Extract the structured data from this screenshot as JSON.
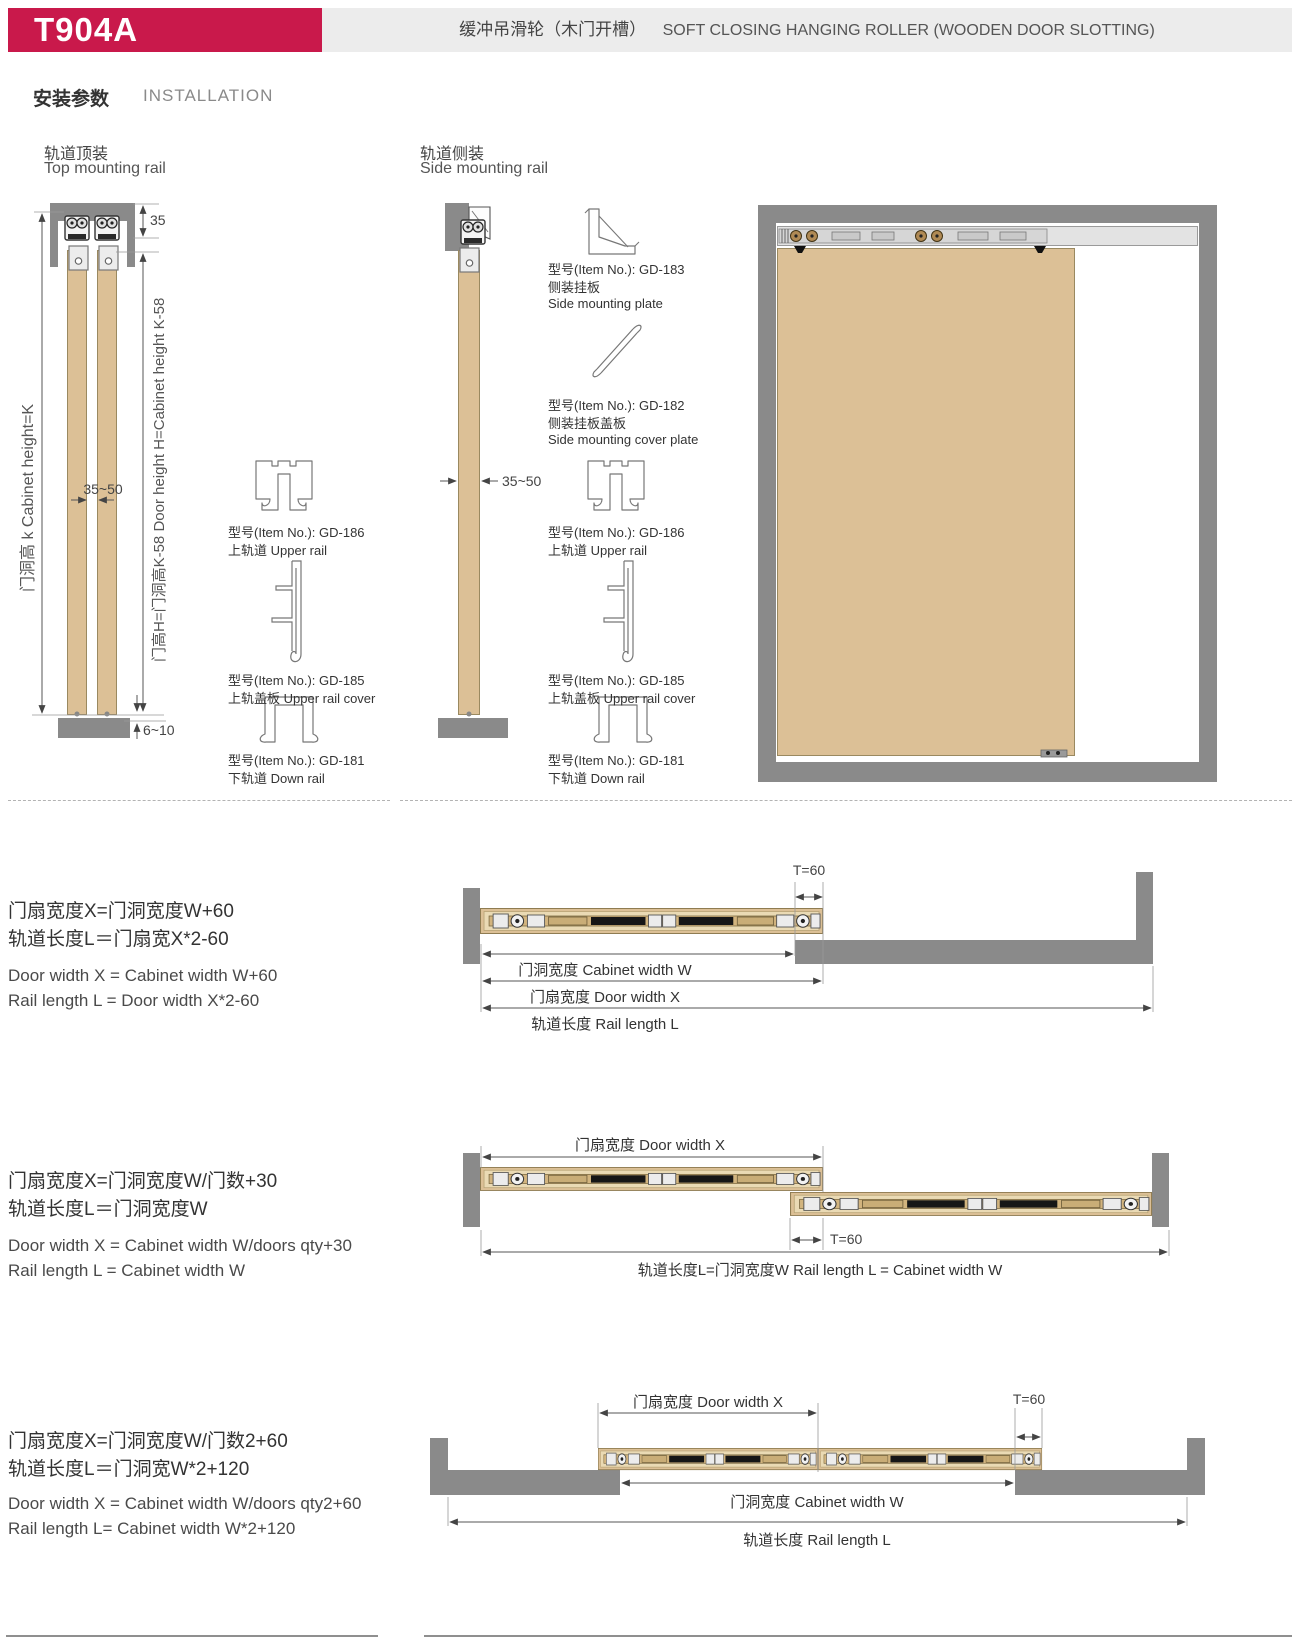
{
  "header": {
    "model": "T904A",
    "title_cn": "缓冲吊滑轮（木门开槽）",
    "title_en": "SOFT CLOSING HANGING ROLLER (WOODEN DOOR SLOTTING)"
  },
  "section": {
    "cn": "安装参数",
    "en": "INSTALLATION"
  },
  "colors": {
    "accent": "#C9194B",
    "banner_gray": "#ECECEC",
    "wall_gray": "#8A8A8A",
    "door_tan": "#DCC096"
  },
  "top_mount": {
    "title_cn": "轨道顶装",
    "title_en": "Top mounting rail",
    "dim_top": "35",
    "dim_gap": "35~50",
    "dim_bottom": "6~10",
    "axis_left": "门洞高 k  Cabinet height=K",
    "axis_right": "门高H=门洞高K-58   Door height H=Cabinet height K-58",
    "parts": [
      {
        "item": "型号(Item No.): GD-186",
        "name": "上轨道 Upper rail"
      },
      {
        "item": "型号(Item No.): GD-185",
        "name": "上轨盖板 Upper rail cover"
      },
      {
        "item": "型号(Item No.): GD-181",
        "name": "下轨道 Down rail"
      }
    ]
  },
  "side_mount": {
    "title_cn": "轨道侧装",
    "title_en": "Side mounting rail",
    "dim_gap": "35~50",
    "parts": [
      {
        "item": "型号(Item No.): GD-183",
        "name": "侧装挂板",
        "name2": "Side mounting plate"
      },
      {
        "item": "型号(Item No.): GD-182",
        "name": "侧装挂板盖板",
        "name2": "Side mounting cover plate"
      },
      {
        "item": "型号(Item No.): GD-186",
        "name": "上轨道 Upper rail"
      },
      {
        "item": "型号(Item No.): GD-185",
        "name": "上轨盖板 Upper rail cover"
      },
      {
        "item": "型号(Item No.): GD-181",
        "name": "下轨道 Down rail"
      }
    ]
  },
  "layout1": {
    "f_cn1": "门扇宽度X=门洞宽度W+60",
    "f_cn2": "轨道长度L＝门扇宽X*2-60",
    "f_en1": "Door width X = Cabinet width W+60",
    "f_en2": "Rail length L = Door width X*2-60",
    "dim_t": "T=60",
    "dim_w": "门洞宽度 Cabinet width W",
    "dim_x": "门扇宽度 Door width X",
    "dim_l": "轨道长度 Rail length L"
  },
  "layout2": {
    "f_cn1": "门扇宽度X=门洞宽度W/门数+30",
    "f_cn2": "轨道长度L＝门洞宽度W",
    "f_en1": "Door width X = Cabinet width W/doors qty+30",
    "f_en2": "Rail length L = Cabinet width W",
    "dim_x": "门扇宽度 Door width X",
    "dim_t": "T=60",
    "dim_l": "轨道长度L=门洞宽度W  Rail length L = Cabinet width W"
  },
  "layout3": {
    "f_cn1": "门扇宽度X=门洞宽度W/门数2+60",
    "f_cn2": "轨道长度L＝门洞宽W*2+120",
    "f_en1": "Door width X = Cabinet width W/doors qty2+60",
    "f_en2": "Rail length L= Cabinet width W*2+120",
    "dim_x": "门扇宽度 Door width X",
    "dim_t": "T=60",
    "dim_w": "门洞宽度 Cabinet width W",
    "dim_l": "轨道长度 Rail length L"
  }
}
